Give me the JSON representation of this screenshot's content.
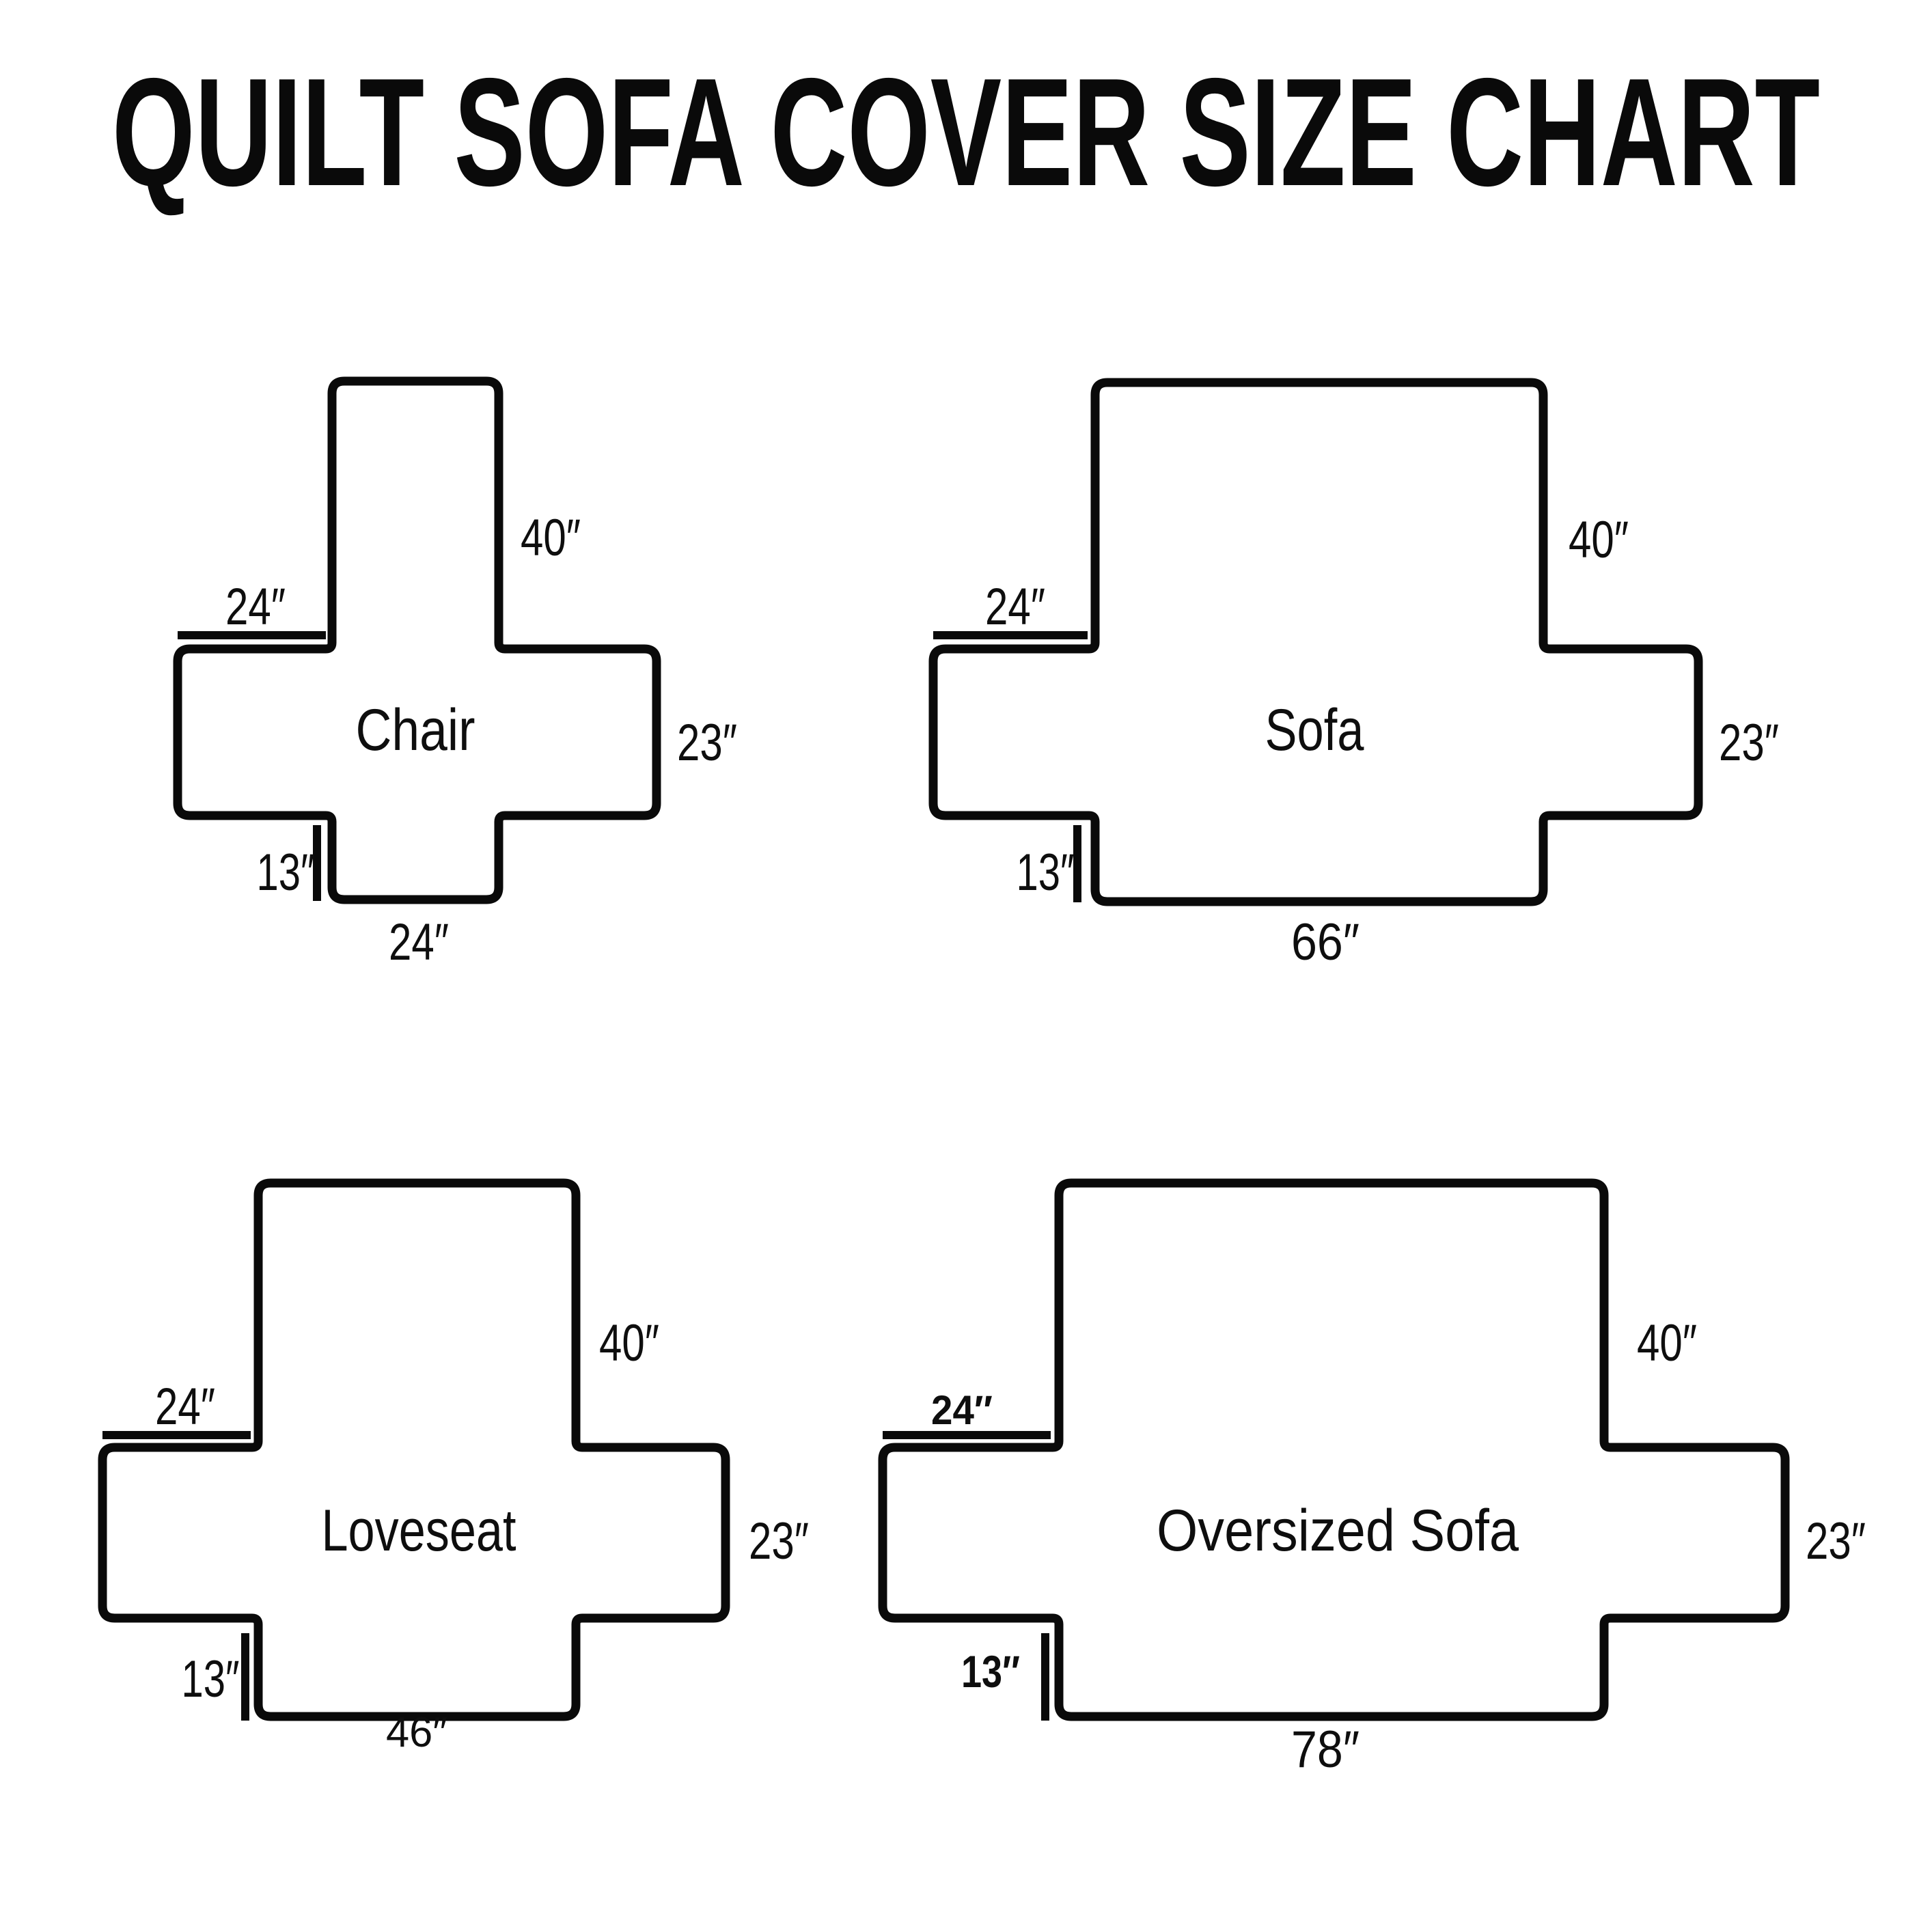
{
  "title": "QUILT SOFA COVER SIZE CHART",
  "diagrams": {
    "chair": {
      "name": "Chair",
      "back_height": "40″",
      "arm_width": "24″",
      "side_height": "23″",
      "front_drop": "13″",
      "seat_width": "24″"
    },
    "sofa": {
      "name": "Sofa",
      "back_height": "40″",
      "arm_width": "24″",
      "side_height": "23″",
      "front_drop": "13″",
      "seat_width": "66″"
    },
    "loveseat": {
      "name": "Loveseat",
      "back_height": "40″",
      "arm_width": "24″",
      "side_height": "23″",
      "front_drop": "13″",
      "seat_width": "46″"
    },
    "oversized_sofa": {
      "name": "Oversized Sofa",
      "back_height": "40″",
      "arm_width": "24″",
      "side_height": "23″",
      "front_drop": "13″",
      "seat_width": "78″"
    }
  }
}
